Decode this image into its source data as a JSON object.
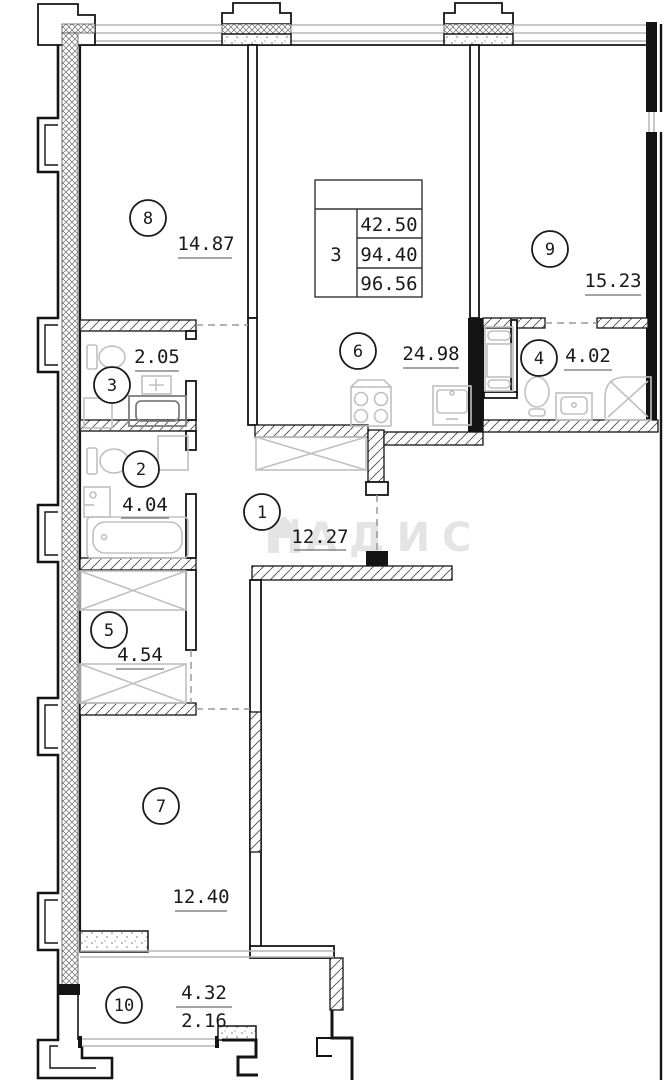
{
  "title": "apartment-floor-plan",
  "spec_table": {
    "rooms_count": "3",
    "values": [
      "42.50",
      "94.40",
      "96.56"
    ]
  },
  "rooms": [
    {
      "number": "1",
      "area": "12.27"
    },
    {
      "number": "2",
      "area": "4.04"
    },
    {
      "number": "3",
      "area": "2.05"
    },
    {
      "number": "4",
      "area": "4.02"
    },
    {
      "number": "5",
      "area": "4.54"
    },
    {
      "number": "6",
      "area": "24.98"
    },
    {
      "number": "7",
      "area": "12.40"
    },
    {
      "number": "8",
      "area": "14.87"
    },
    {
      "number": "9",
      "area": "15.23"
    },
    {
      "number": "10",
      "area": "4.32",
      "area_reduced": "2.16"
    }
  ],
  "watermark": {
    "text": "АДИС"
  },
  "colors": {
    "wall": "#141414",
    "fixture": "#c0c0c0",
    "dash": "#9a9a9a",
    "window": "#b5b5b5",
    "text": "#1a1a1a",
    "watermark": "#e4e4e4",
    "background": "#ffffff"
  }
}
